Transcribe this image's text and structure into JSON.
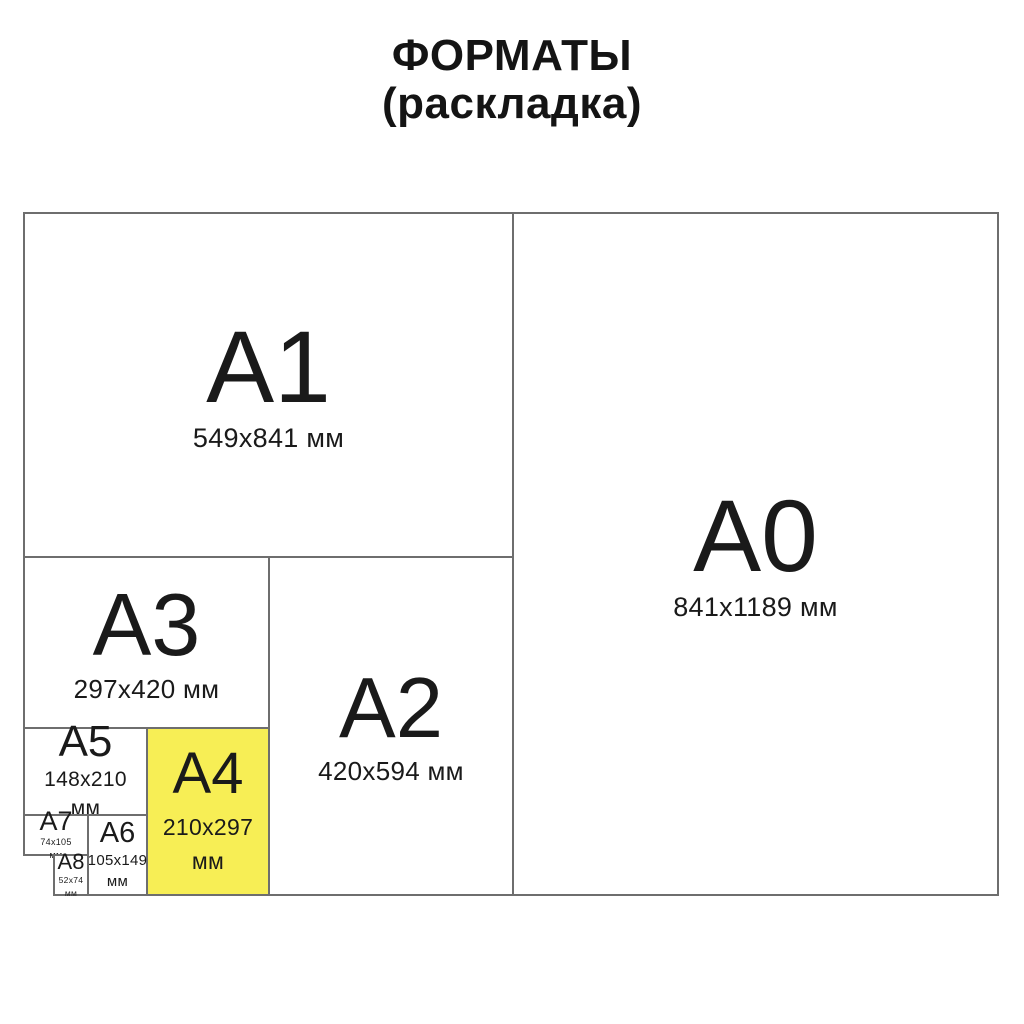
{
  "title": {
    "line1": "ФОРМАТЫ",
    "line2": "(раскладка)"
  },
  "colors": {
    "highlight": "#F7EE55",
    "border": "#6E6E6E",
    "text": "#1A1A1A"
  },
  "formats": {
    "a0": {
      "label": "A0",
      "dims": "841x1189 мм"
    },
    "a1": {
      "label": "A1",
      "dims": "549x841 мм"
    },
    "a2": {
      "label": "A2",
      "dims": "420x594 мм"
    },
    "a3": {
      "label": "A3",
      "dims": "297x420 мм"
    },
    "a4": {
      "label": "A4",
      "size": "210x297",
      "unit": "мм",
      "highlighted": true
    },
    "a5": {
      "label": "A5",
      "size": "148x210",
      "unit": "мм"
    },
    "a6": {
      "label": "A6",
      "size": "105x149",
      "unit": "мм"
    },
    "a7": {
      "label": "A7",
      "size": "74x105",
      "unit": "мм"
    },
    "a8": {
      "label": "A8",
      "size": "52x74",
      "unit": "мм"
    }
  }
}
